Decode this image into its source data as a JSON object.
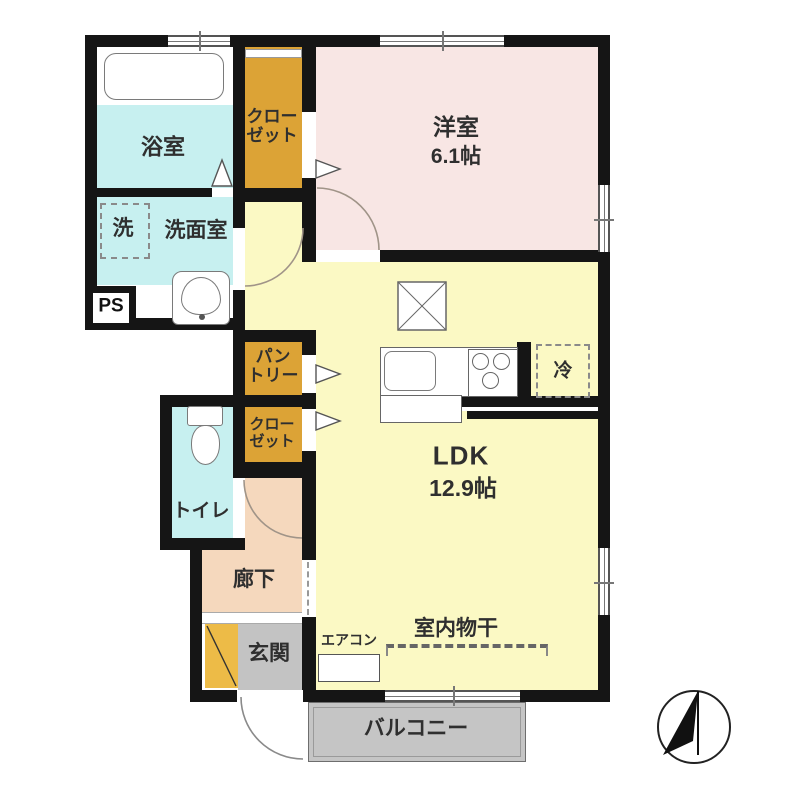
{
  "rooms": {
    "bath": {
      "label": "浴室"
    },
    "washer": {
      "label": "洗"
    },
    "washroom": {
      "label": "洗面室"
    },
    "ps": {
      "label": "PS"
    },
    "closet_top": {
      "label": "クロー\nゼット"
    },
    "western_room": {
      "label": "洋室",
      "size": "6.1帖"
    },
    "pantry": {
      "label": "パン\nトリー"
    },
    "closet_mid": {
      "label": "クロー\nゼット"
    },
    "toilet": {
      "label": "トイレ"
    },
    "hallway": {
      "label": "廊下"
    },
    "entrance": {
      "label": "玄関"
    },
    "ldk": {
      "label": "LDK",
      "size": "12.9帖"
    },
    "fridge": {
      "label": "冷"
    },
    "aircon": {
      "label": "エアコン"
    },
    "indoor_drying": {
      "label": "室内物干"
    },
    "balcony": {
      "label": "バルコニー"
    }
  },
  "icons": {
    "compass": "north-arrow"
  },
  "colors": {
    "wall": "#151515",
    "water_rooms": "#c7f0f0",
    "western_room": "#f8e6e4",
    "ldk": "#fbf9c4",
    "closet": "#dca336",
    "hallway": "#f5d8bd",
    "entrance_gray": "#c3c3c3",
    "balcony": "#c5c5c5",
    "shoe_cabinet": "#edbb47"
  }
}
